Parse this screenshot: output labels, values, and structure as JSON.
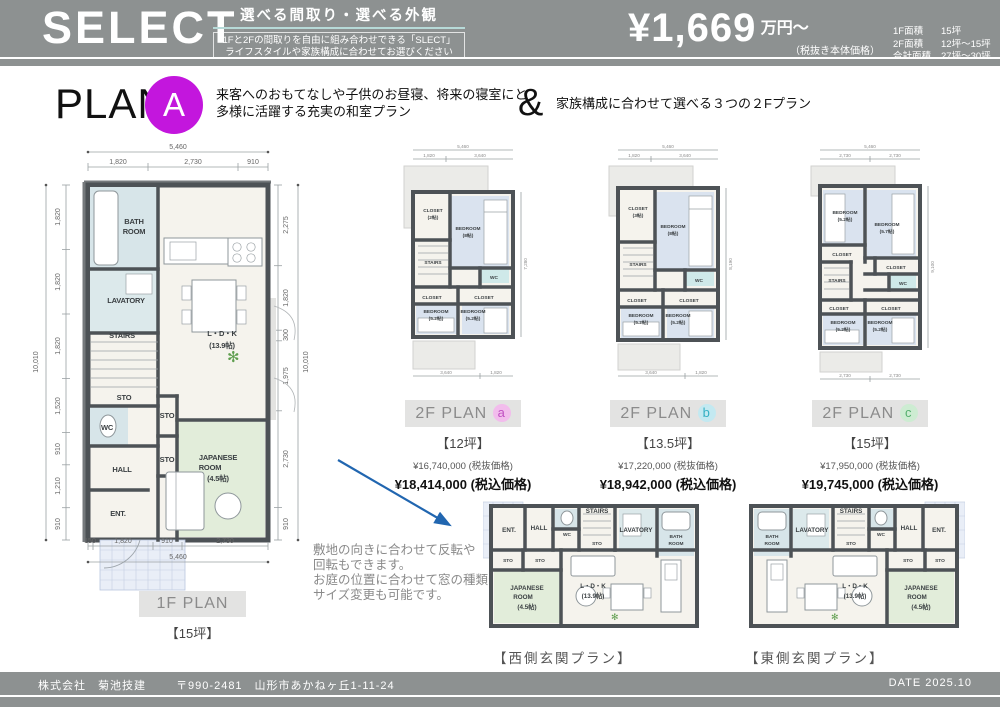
{
  "colors": {
    "header_gray": "#8d9191",
    "accent_a": "#c316dd",
    "badge_a": "#f2bcec",
    "badge_b": "#c3e9f1",
    "badge_c": "#cdecd2",
    "arrow_blue": "#2166b0",
    "tatami_green": "#e2edda",
    "water_blue": "#d7e5e9"
  },
  "icons": {
    "plant": "✻"
  },
  "header": {
    "logo": "SELECT",
    "tagline": "選べる間取り・選べる外観",
    "sub1": "1Fと2Fの間取りを自由に組み合わせできる「SLECT」",
    "sub2": "ライフスタイルや家族構成に合わせてお選びください",
    "price": "¥1,669",
    "price_unit": "万円〜",
    "price_note": "（税抜き本体価格）",
    "areas": [
      {
        "label": "1F面積",
        "value": "15坪"
      },
      {
        "label": "2F面積",
        "value": "12坪〜15坪"
      },
      {
        "label": "合計面積",
        "value": "27坪〜30坪"
      }
    ]
  },
  "plana": {
    "word": "PLAN",
    "letter": "A",
    "d1": "来客へのおもてなしや子供のお昼寝、将来の寝室にと",
    "d2": "多様に活躍する充実の和室プラン",
    "amp": "&",
    "d3": "家族構成に合わせて選べる３つの２Fプラン"
  },
  "f1": {
    "label": "1F PLAN",
    "size": "【15坪】",
    "rooms": {
      "bath1": "BATH",
      "bath2": "ROOM",
      "lav": "LAVATORY",
      "stairs": "STAIRS",
      "sto1": "STO",
      "wc": "WC",
      "hall": "HALL",
      "ent": "ENT.",
      "sto2": "STO",
      "sto3": "STO",
      "jp1": "JAPANESE",
      "jp2": "ROOM",
      "jp3": "(4.5帖)",
      "ldk1": "L・D・K",
      "ldk2": "(13.9帖)"
    },
    "dims": {
      "tt": "5,460",
      "t": [
        "1,820",
        "2,730",
        "910"
      ],
      "lt": "10,010",
      "l": [
        "1,820",
        "1,820",
        "1,820",
        "1,520",
        "910",
        "1,210",
        "910"
      ],
      "rt": "10,010",
      "r": [
        "2,275",
        "1,820",
        "300",
        "1,975",
        "2,730",
        "910"
      ],
      "b": [
        "150",
        "1,820",
        "910",
        "2,730"
      ],
      "bt": "5,460"
    }
  },
  "p2a": {
    "label": "2F PLAN",
    "letter": "a",
    "size": "【12坪】",
    "price1": "¥16,740,000 (税抜価格)",
    "price2": "¥18,414,000 (税込価格)",
    "rooms": {
      "cl1a": "CLOSET",
      "cl1b": "(2帖)",
      "bd1a": "BEDROOM",
      "bd1b": "(8帖)",
      "stairs": "STAIRS",
      "wc": "WC",
      "cl2": "CLOSET",
      "cl3": "CLOSET",
      "bd2a": "BEDROOM",
      "bd2b": "(5.2帖)",
      "bd3a": "BEDROOM",
      "bd3b": "(5.2帖)"
    },
    "dims": {
      "tt": "5,460",
      "t": [
        "1,820",
        "3,640"
      ],
      "rt": "7,280",
      "b": [
        "3,640",
        "1,820"
      ]
    }
  },
  "p2b": {
    "label": "2F PLAN",
    "letter": "b",
    "size": "【13.5坪】",
    "price1": "¥17,220,000 (税抜価格)",
    "price2": "¥18,942,000 (税込価格)",
    "rooms": {
      "cl1a": "CLOSET",
      "cl1b": "(3帖)",
      "bd1a": "BEDROOM",
      "bd1b": "(8帖)",
      "stairs": "STAIRS",
      "wc": "WC",
      "cl2": "CLOSET",
      "cl3": "CLOSET",
      "bd2a": "BEDROOM",
      "bd2b": "(5.2帖)",
      "bd3a": "BEDROOM",
      "bd3b": "(5.2帖)"
    },
    "dims": {
      "tt": "5,460",
      "t": [
        "1,820",
        "3,640"
      ],
      "rt": "8,190",
      "b": [
        "3,640",
        "1,820"
      ]
    }
  },
  "p2c": {
    "label": "2F PLAN",
    "letter": "c",
    "size": "【15坪】",
    "price1": "¥17,950,000 (税抜価格)",
    "price2": "¥19,745,000 (税込価格)",
    "rooms": {
      "bd1a": "BEDROOM",
      "bd1b": "(5.2帖)",
      "bd2a": "BEDROOM",
      "bd2b": "(5.7帖)",
      "cl1": "CLOSET",
      "stairs": "STAIRS",
      "cl2": "CLOSET",
      "wc": "WC",
      "cl3": "CLOSET",
      "cl4": "CLOSET",
      "bd3a": "BEDROOM",
      "bd3b": "(5.2帖)",
      "bd4a": "BEDROOM",
      "bd4b": "(5.2帖)"
    },
    "dims": {
      "tt": "5,460",
      "t": [
        "2,730",
        "2,730"
      ],
      "rt": "9,100",
      "b": [
        "2,730",
        "2,730"
      ]
    }
  },
  "note": {
    "l1": "敷地の向きに合わせて反転や",
    "l2": "回転もできます。",
    "l3": "お庭の位置に合わせて窓の種類や",
    "l4": "サイズ変更も可能です。"
  },
  "west": {
    "caption": "【西側玄関プラン】",
    "rooms": {
      "ent": "ENT.",
      "hall": "HALL",
      "wc": "WC",
      "stairs": "STAIRS",
      "sto1": "STO",
      "lav": "LAVATORY",
      "bath1": "BATH",
      "bath2": "ROOM",
      "sto2": "STO",
      "sto3": "STO",
      "jp1": "JAPANESE",
      "jp2": "ROOM",
      "jp3": "(4.5帖)",
      "ldk1": "L・D・K",
      "ldk2": "(13.9帖)"
    }
  },
  "east": {
    "caption": "【東側玄関プラン】",
    "rooms": {
      "bath1": "BATH",
      "bath2": "ROOM",
      "lav": "LAVATORY",
      "stairs": "STAIRS",
      "sto1": "STO",
      "wc": "WC",
      "hall": "HALL",
      "ent": "ENT.",
      "sto2": "STO",
      "sto3": "STO",
      "ldk1": "L・D・K",
      "ldk2": "(13.9帖)",
      "jp1": "JAPANESE",
      "jp2": "ROOM",
      "jp3": "(4.5帖)"
    }
  },
  "footer": {
    "company": "株式会社　菊池技建",
    "address": "〒990-2481　山形市あかねヶ丘1-11-24",
    "date": "DATE 2025.10"
  }
}
